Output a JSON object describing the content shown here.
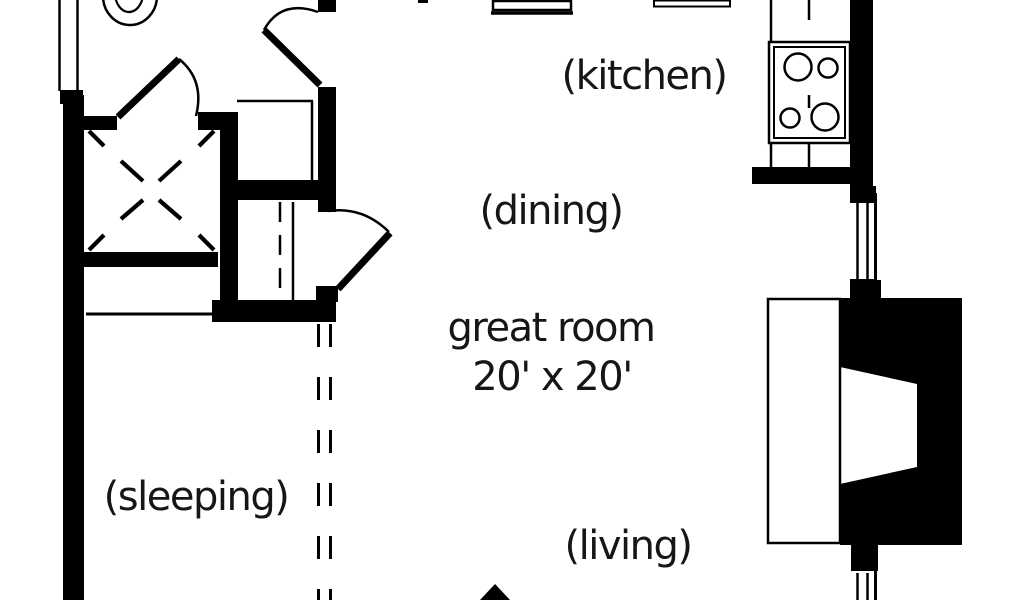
{
  "title": "house floor plan",
  "labels": {
    "kitchen": "(kitchen)",
    "dining": "(dining)",
    "great_room": "great room",
    "great_room_size": "20' x 20'",
    "sleeping": "(sleeping)",
    "living": "(living)"
  },
  "fixtures": {
    "toilet": "toilet-top-view",
    "cooktop": "cooktop-4-burner",
    "fireplace": "fireplace-with-hearth",
    "closet_marker": "x-closet-marker",
    "windows": [
      "left-window",
      "right-upper-window",
      "right-lower-window"
    ],
    "doors": [
      "bathroom-swing-door",
      "hall-closet-swing-door",
      "great-room-swing-door"
    ],
    "entry_arrow": "entry-arrow-up"
  },
  "colors": {
    "wall": "#000000",
    "background": "#ffffff",
    "text": "#161616"
  }
}
